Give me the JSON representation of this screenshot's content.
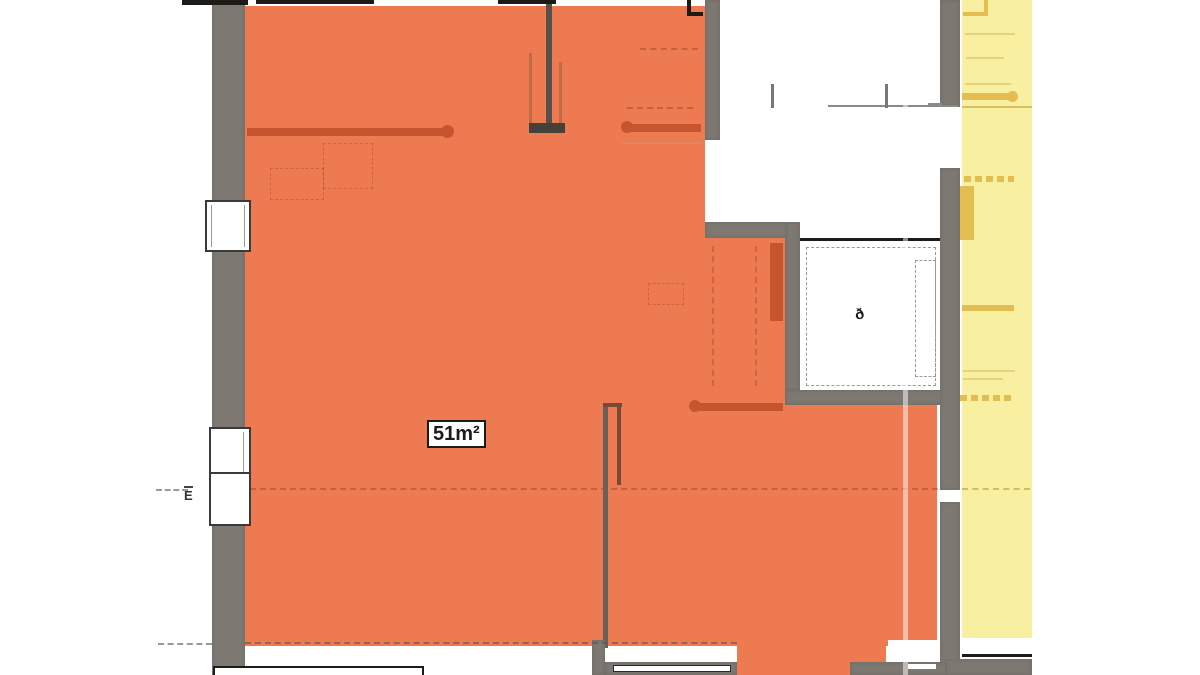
{
  "plan": {
    "area_label": "51m²",
    "left_mark": "E"
  },
  "icons": {
    "elevator_symbol": "ð"
  },
  "colors": {
    "apartment_fill": "#ee7a52",
    "apartment_line": "#c6552f",
    "adjacent_fill": "#f8efa0",
    "adjacent_line": "#e3bd50",
    "wall_gray": "#7d7871",
    "ink": "#1d1b18",
    "label_bg": "#ffffff"
  }
}
